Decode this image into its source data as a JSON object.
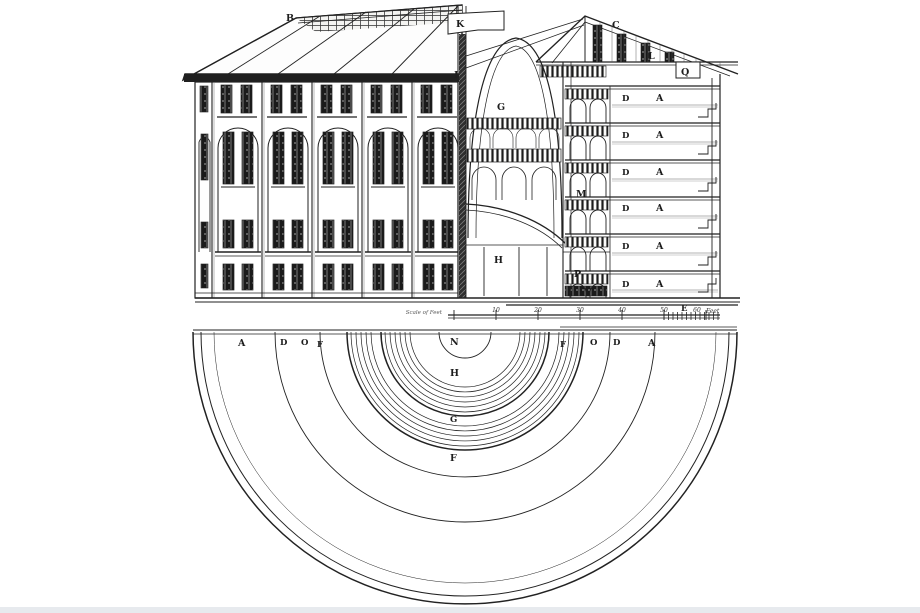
{
  "colors": {
    "paper": "#ffffff",
    "ink": "#222222",
    "footer_strip": "#e7eaee"
  },
  "elevation": {
    "roof_label": "B"
  },
  "section": {
    "skylight_label": "K",
    "roof_label": "C",
    "eaves_label": "I",
    "attic_label": "L",
    "stair_label": "Q",
    "well_label": "G",
    "gallery_label": "M",
    "chapel_label": "H",
    "lodge_label": "P",
    "ground_label": "E",
    "floors": [
      {
        "door": "D",
        "cell": "A"
      },
      {
        "door": "D",
        "cell": "A"
      },
      {
        "door": "D",
        "cell": "A"
      },
      {
        "door": "D",
        "cell": "A"
      },
      {
        "door": "D",
        "cell": "A"
      },
      {
        "door": "D",
        "cell": "A"
      }
    ]
  },
  "scale": {
    "note": "Scale of Feet",
    "ticks": [
      "10",
      "20",
      "30",
      "40",
      "50",
      "60"
    ],
    "unit": "Feet"
  },
  "plan": {
    "center_label": "N",
    "chapel_label": "H",
    "gallery_label": "G",
    "corridor_label": "F",
    "top_row_left": [
      "A",
      "D",
      "O",
      "F"
    ],
    "top_row_right": [
      "F",
      "O",
      "D",
      "A"
    ],
    "cell_label": "A",
    "cell_count": 13
  }
}
